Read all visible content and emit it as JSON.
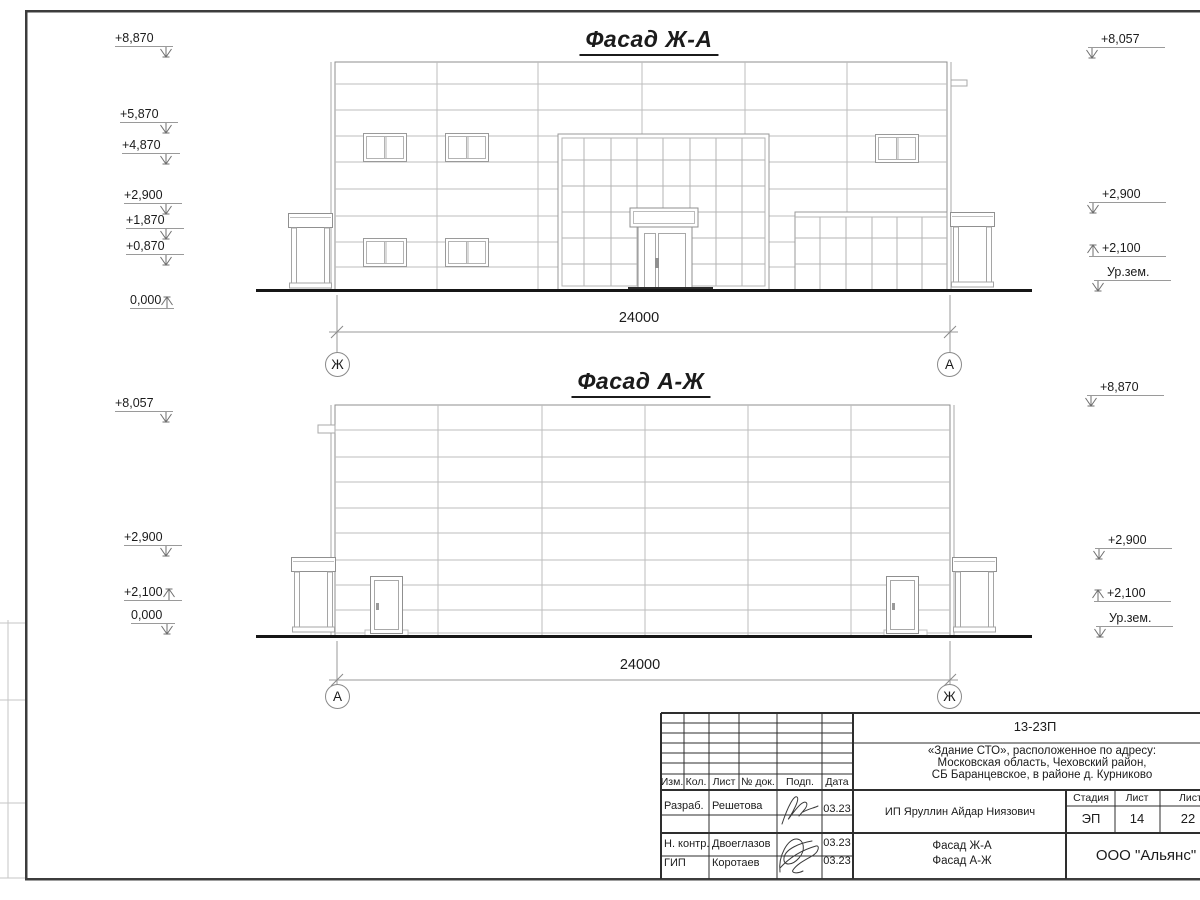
{
  "facade1": {
    "title": "Фасад Ж-А",
    "dimension": "24000",
    "axis_left": "Ж",
    "axis_right": "А",
    "left_marks": [
      "+8,870",
      "+5,870",
      "+4,870",
      "+2,900",
      "+1,870",
      "+0,870",
      "0,000"
    ],
    "right_marks": [
      "+8,057",
      "+2,900",
      "+2,100",
      "Ур.зем."
    ]
  },
  "facade2": {
    "title": "Фасад А-Ж",
    "dimension": "24000",
    "axis_left": "А",
    "axis_right": "Ж",
    "left_marks": [
      "+8,057",
      "+2,900",
      "+2,100",
      "0,000"
    ],
    "right_marks": [
      "+8,870",
      "+2,900",
      "+2,100",
      "Ур.зем."
    ]
  },
  "title_block": {
    "project_code": "13-23П",
    "address_line1": "«Здание СТО», расположенное по адресу:",
    "address_line2": "Московская область, Чеховский район,",
    "address_line3": "СБ Баранцевское, в районе д. Курниково",
    "columns": [
      "Изм.",
      "Кол.",
      "Лист",
      "№ док.",
      "Подп.",
      "Дата"
    ],
    "rows": [
      {
        "role": "Разраб.",
        "name": "Решетова",
        "date": "03.23"
      },
      {
        "role": "Н. контр.",
        "name": "Двоеглазов",
        "date": "03.23"
      },
      {
        "role": "ГИП",
        "name": "Коротаев",
        "date": "03.23"
      }
    ],
    "client": "ИП Яруллин Айдар Ниязович",
    "stage_label": "Стадия",
    "sheet_label": "Лист",
    "sheets_label": "Листов",
    "stage": "ЭП",
    "sheet_number": "14",
    "sheets_total": "22",
    "drawing_title_line1": "Фасад Ж-А",
    "drawing_title_line2": "Фасад А-Ж",
    "company": "ООО \"Альянс\""
  },
  "colors": {
    "line_thin": "#bdbdbd",
    "line_outline": "#8f8f8f",
    "line_ground": "#161616",
    "text": "#1b1b1b"
  }
}
